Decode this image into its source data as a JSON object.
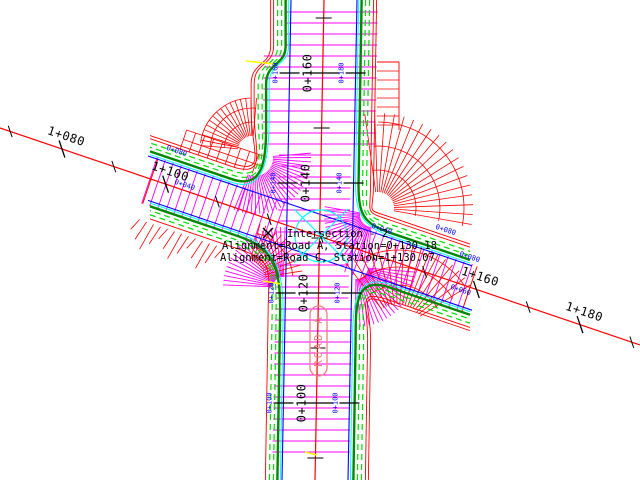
{
  "canvas": {
    "width": 640,
    "height": 480,
    "background": "#ffffff"
  },
  "colors": {
    "centerline": "#ff0000",
    "edge_of_pavement": "#0000ff",
    "hatch": "#ff00ff",
    "curb": "#008700",
    "sidewalk_dashed": "#00dd00",
    "cyan_accent": "#00ffff",
    "daylight": "#ff0000",
    "tick": "#000000",
    "station_label": "#000000",
    "edge_station_label": "#0000ff",
    "road_name_label": "#f08080",
    "center_marker": "#00ffff",
    "highlight": "#ffff00"
  },
  "annotation": {
    "title": "Intersection - 2",
    "alignment_a": "Alignment=Road A, Station=0+130.18",
    "alignment_c": "Alignment=Road C, Station=1+130.07"
  },
  "road_a": {
    "label": "ROAD A",
    "centerline_stations": [
      {
        "label": "0+160",
        "y": 73
      },
      {
        "label": "0+140",
        "y": 183
      },
      {
        "label": "0+120",
        "y": 293
      },
      {
        "label": "0+100",
        "y": 403
      }
    ],
    "edge_stations_left": [
      {
        "label": "0+160",
        "y": 73
      },
      {
        "label": "0+140",
        "y": 183
      },
      {
        "label": "0+120",
        "y": 293
      },
      {
        "label": "0+100",
        "y": 403
      }
    ],
    "edge_stations_right": [
      {
        "label": "0+180",
        "y": 73
      },
      {
        "label": "0+140",
        "y": 183
      },
      {
        "label": "0+120",
        "y": 293
      },
      {
        "label": "0+100",
        "y": 403
      }
    ]
  },
  "road_c": {
    "centerline_stations": [
      {
        "label": "1+080",
        "x": 62
      },
      {
        "label": "1+100",
        "x": 166
      },
      {
        "label": "1+160",
        "x": 476
      },
      {
        "label": "1+180",
        "x": 580
      }
    ],
    "edge_stations": [
      {
        "label": "0+080",
        "x": 176,
        "y": 153
      },
      {
        "label": "0+040",
        "x": 184,
        "y": 187
      },
      {
        "label": "0+040",
        "x": 381,
        "y": 231
      },
      {
        "label": "0+080",
        "x": 445,
        "y": 232
      },
      {
        "label": "0+080",
        "x": 469,
        "y": 259
      },
      {
        "label": "0+060",
        "x": 460,
        "y": 292
      }
    ]
  }
}
